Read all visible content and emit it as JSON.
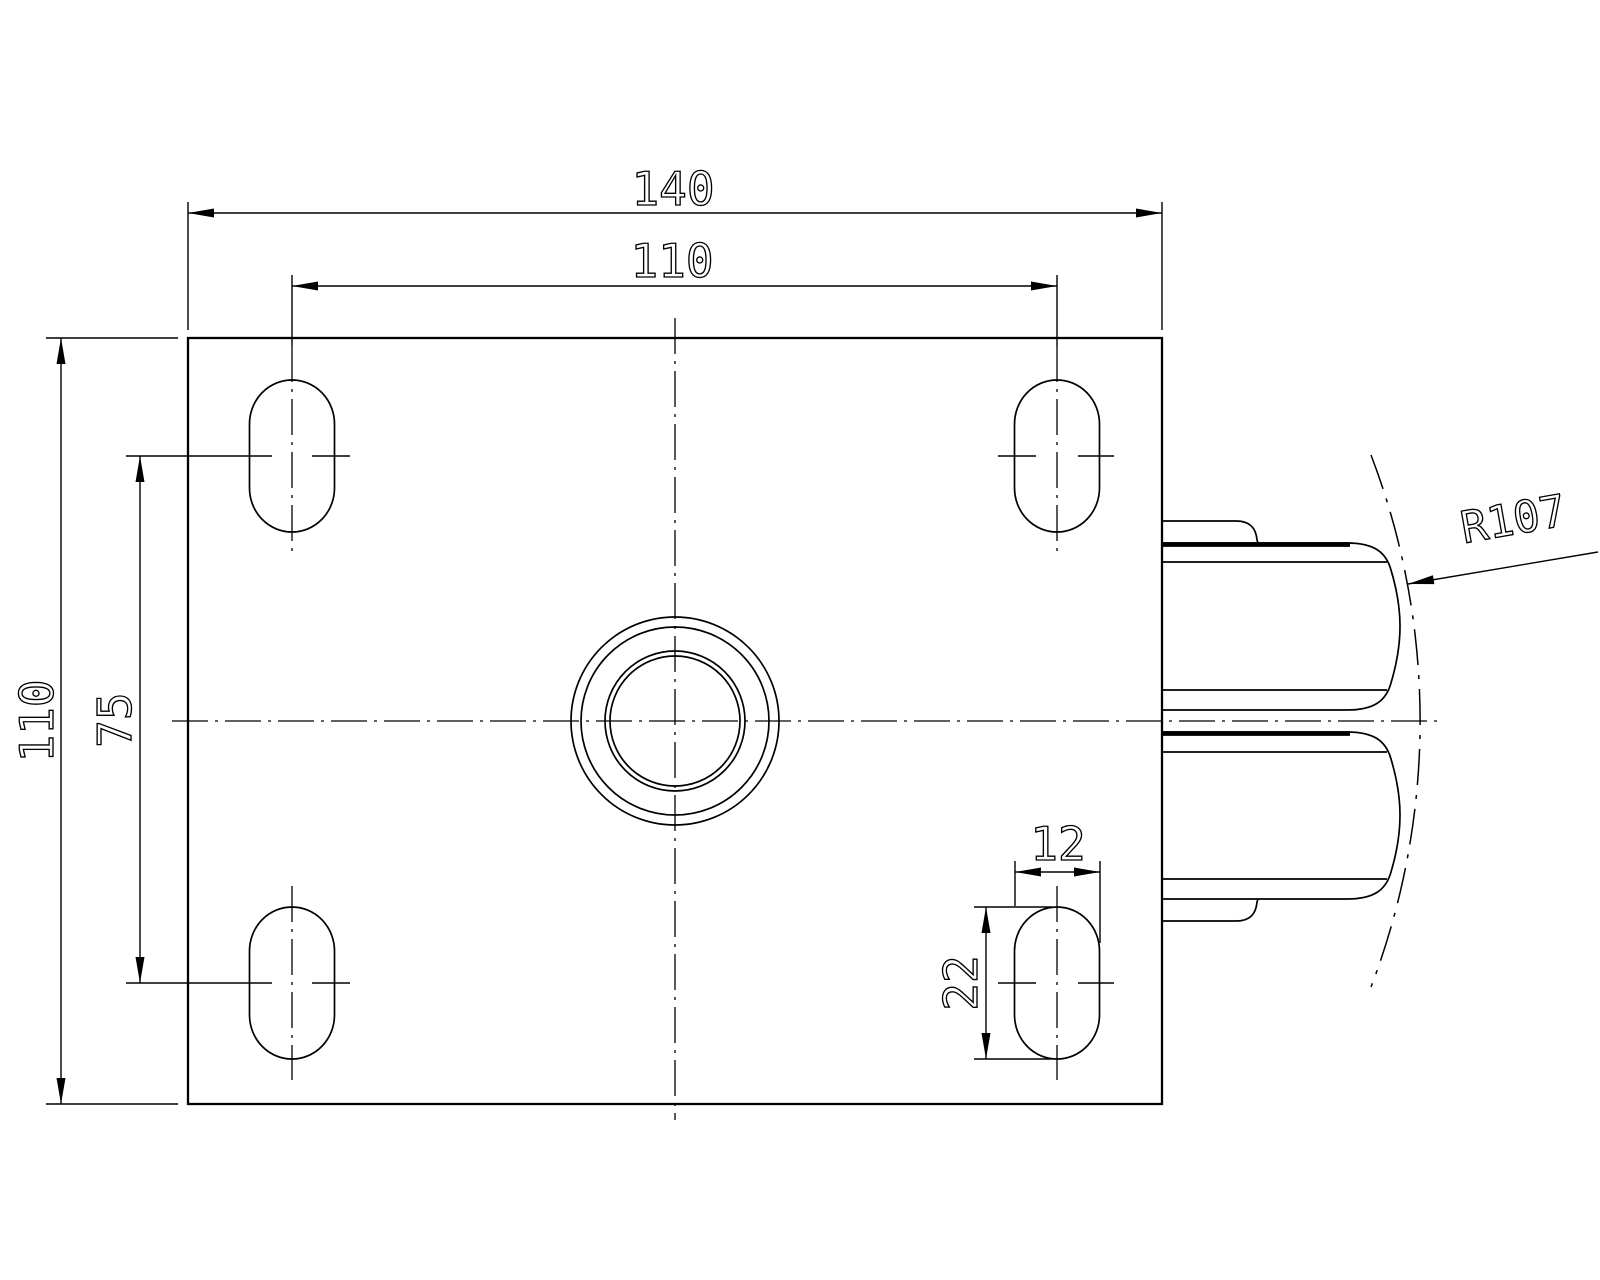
{
  "drawing": {
    "colors": {
      "line": "#000000",
      "background": "#ffffff"
    },
    "labels": {
      "plate_width": "140",
      "bolt_hole_spacing_width": "110",
      "plate_depth": "110",
      "bolt_hole_spacing_depth": "75",
      "slot_width": "12",
      "slot_length": "22",
      "wheel_radius": "R107"
    }
  }
}
